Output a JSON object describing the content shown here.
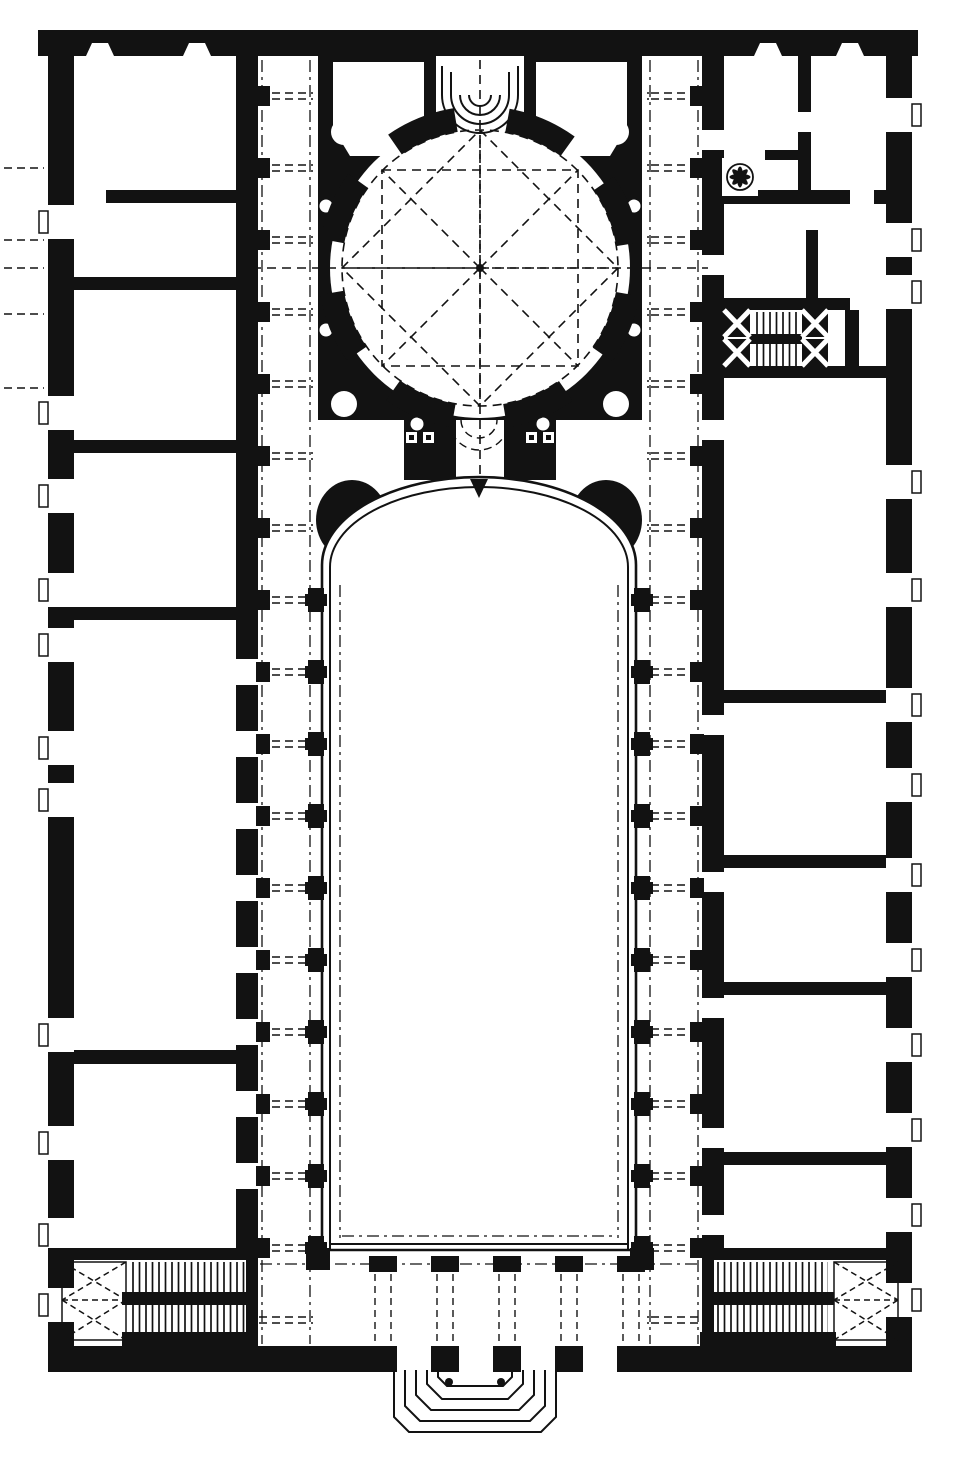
{
  "canvas": {
    "width": 960,
    "height": 1475,
    "paper": "#ffffff",
    "ink": "#121212"
  },
  "plan": {
    "title": "Engraved black-and-white floor plan of a monastic church complex",
    "drawing_type": "architectural floor plan",
    "elements": [
      {
        "id": "domed-sanctuary",
        "label": "Octagonal domed sanctuary with radiating dashed setting-out lines"
      },
      {
        "id": "high-altar-apse",
        "label": "Stepped semicircular apse at the top of the sanctuary"
      },
      {
        "id": "corner-chapels",
        "label": "Angled corner chapels flanking the sanctuary"
      },
      {
        "id": "choir-passage",
        "label": "Columned choir passage linking dome and nave"
      },
      {
        "id": "nave-hall",
        "label": "Long nave court with semicircular apsidal end"
      },
      {
        "id": "side-corridors",
        "label": "Vaulted side corridors with pier arcades and bay dashes"
      },
      {
        "id": "room-wings",
        "label": "Ranges of rooms along the left and right outer walls"
      },
      {
        "id": "loggia-openings",
        "label": "Pierced arcade wall between left rooms and corridor"
      },
      {
        "id": "service-stairs",
        "label": "Dog-leg stair and spiral stair in the upper right wing"
      },
      {
        "id": "grand-stairs",
        "label": "Twin dog-leg staircases with cross-marked landings, lower corners"
      },
      {
        "id": "front-portico",
        "label": "Entrance portico arcade along the bottom wall"
      },
      {
        "id": "entrance-steps",
        "label": "Concentric stepped entrance platform at bottom centre"
      }
    ]
  }
}
